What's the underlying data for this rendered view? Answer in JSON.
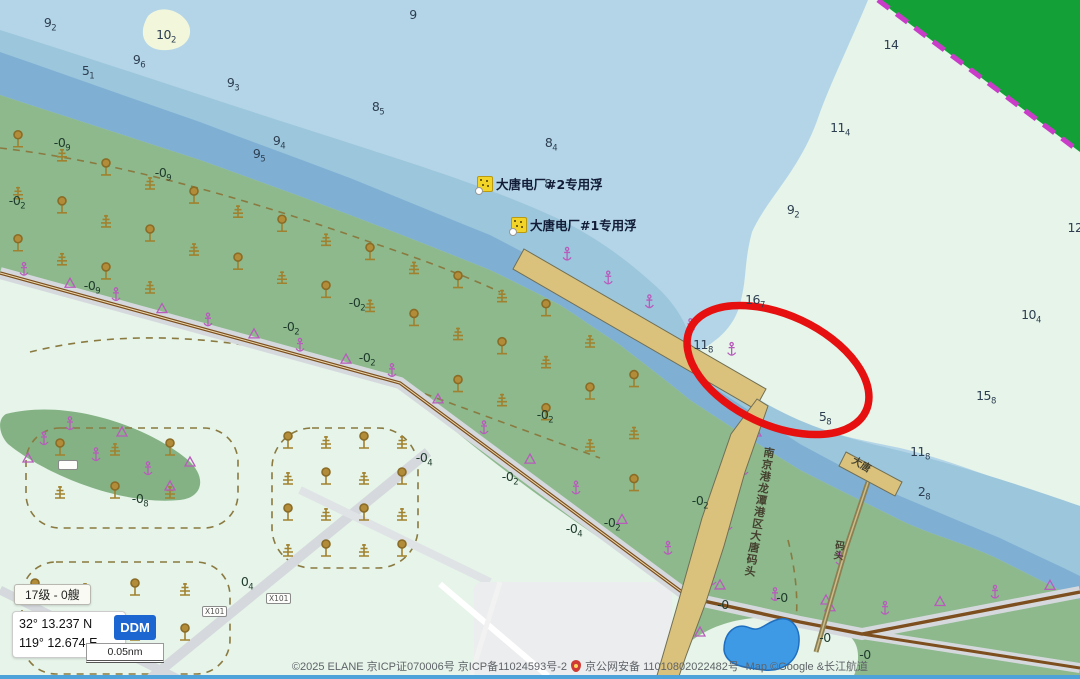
{
  "map": {
    "buoys": [
      {
        "label": "大唐电厂#2专用浮"
      },
      {
        "label": "大唐电厂#1专用浮"
      }
    ],
    "pier_labels": {
      "main": "南京港龙潭港区大唐码头",
      "small_top": "大唐",
      "small_bottom": "码头"
    },
    "road_signs": [
      {
        "text": "X101"
      },
      {
        "text": "X101"
      },
      {
        "text": ""
      }
    ],
    "annotation": {
      "shape": "ellipse",
      "color": "#e61010"
    },
    "soundings": [
      {
        "x": 50,
        "y": 23,
        "v": "9",
        "s": "2",
        "k": "w"
      },
      {
        "x": 166,
        "y": 35,
        "v": "10",
        "s": "2",
        "k": "w"
      },
      {
        "x": 413,
        "y": 15,
        "v": "9",
        "s": "",
        "k": "w"
      },
      {
        "x": 88,
        "y": 71,
        "v": "5",
        "s": "1",
        "k": "w"
      },
      {
        "x": 139,
        "y": 60,
        "v": "9",
        "s": "6",
        "k": "w"
      },
      {
        "x": 233,
        "y": 83,
        "v": "9",
        "s": "3",
        "k": "w"
      },
      {
        "x": 378,
        "y": 107,
        "v": "8",
        "s": "5",
        "k": "w"
      },
      {
        "x": 279,
        "y": 141,
        "v": "9",
        "s": "4",
        "k": "w"
      },
      {
        "x": 259,
        "y": 154,
        "v": "9",
        "s": "5",
        "k": "w"
      },
      {
        "x": 551,
        "y": 143,
        "v": "8",
        "s": "4",
        "k": "w"
      },
      {
        "x": 548,
        "y": 184,
        "v": "8",
        "s": "",
        "k": "w"
      },
      {
        "x": 840,
        "y": 128,
        "v": "11",
        "s": "4",
        "k": "w"
      },
      {
        "x": 891,
        "y": 45,
        "v": "14",
        "s": "",
        "k": "w"
      },
      {
        "x": 793,
        "y": 210,
        "v": "9",
        "s": "2",
        "k": "w"
      },
      {
        "x": 755,
        "y": 300,
        "v": "16",
        "s": "7",
        "k": "w"
      },
      {
        "x": 1031,
        "y": 315,
        "v": "10",
        "s": "4",
        "k": "w"
      },
      {
        "x": 703,
        "y": 345,
        "v": "11",
        "s": "8",
        "k": "w"
      },
      {
        "x": 986,
        "y": 396,
        "v": "15",
        "s": "8",
        "k": "w"
      },
      {
        "x": 825,
        "y": 417,
        "v": "5",
        "s": "8",
        "k": "w"
      },
      {
        "x": 920,
        "y": 452,
        "v": "11",
        "s": "8",
        "k": "w"
      },
      {
        "x": 924,
        "y": 492,
        "v": "2",
        "s": "8",
        "k": "w"
      },
      {
        "x": 1075,
        "y": 228,
        "v": "12",
        "s": "",
        "k": "w"
      },
      {
        "x": 17,
        "y": 201,
        "v": "-0",
        "s": "2",
        "k": "l"
      },
      {
        "x": 62,
        "y": 143,
        "v": "-0",
        "s": "9",
        "k": "l"
      },
      {
        "x": 163,
        "y": 173,
        "v": "-0",
        "s": "9",
        "k": "l"
      },
      {
        "x": 92,
        "y": 286,
        "v": "-0",
        "s": "9",
        "k": "l"
      },
      {
        "x": 357,
        "y": 303,
        "v": "-0",
        "s": "2",
        "k": "l"
      },
      {
        "x": 291,
        "y": 327,
        "v": "-0",
        "s": "2",
        "k": "l"
      },
      {
        "x": 367,
        "y": 358,
        "v": "-0",
        "s": "2",
        "k": "l"
      },
      {
        "x": 545,
        "y": 415,
        "v": "-0",
        "s": "2",
        "k": "l"
      },
      {
        "x": 424,
        "y": 458,
        "v": "-0",
        "s": "4",
        "k": "l"
      },
      {
        "x": 510,
        "y": 477,
        "v": "-0",
        "s": "2",
        "k": "l"
      },
      {
        "x": 574,
        "y": 529,
        "v": "-0",
        "s": "4",
        "k": "l"
      },
      {
        "x": 612,
        "y": 523,
        "v": "-0",
        "s": "2",
        "k": "l"
      },
      {
        "x": 140,
        "y": 499,
        "v": "-0",
        "s": "8",
        "k": "l"
      },
      {
        "x": 700,
        "y": 501,
        "v": "-0",
        "s": "2",
        "k": "l"
      },
      {
        "x": 723,
        "y": 605,
        "v": "-0",
        "s": "",
        "k": "l"
      },
      {
        "x": 782,
        "y": 598,
        "v": "-0",
        "s": "",
        "k": "l"
      },
      {
        "x": 825,
        "y": 638,
        "v": "-0",
        "s": "",
        "k": "l"
      },
      {
        "x": 865,
        "y": 655,
        "v": "-0",
        "s": "",
        "k": "l"
      },
      {
        "x": 247,
        "y": 582,
        "v": "0",
        "s": "4",
        "k": "l"
      }
    ]
  },
  "ui": {
    "level_badge": "17级 - 0艘",
    "position": {
      "lat": "32° 13.237 N",
      "lon": "119° 12.674 E"
    },
    "format_button": "DDM",
    "scale_label": "0.05nm",
    "copyright_left": "©2025 ELANE  京ICP证070006号  京ICP备11024593号-2",
    "copyright_right": "京公网安备 11010802022482号  -Map ©Google &长江航道"
  },
  "colors": {
    "water_light": "#b3d5e7",
    "water_mid": "#9cc6dc",
    "water_dark": "#7fb0d4",
    "shallow_flat": "#e6f4e9",
    "land_green": "#8db98d",
    "forest_green": "#12a037",
    "jetty_tan": "#dac17c",
    "annotation_red": "#e61010",
    "symbol_magenta": "#b85cbc",
    "tree_brown": "#a0812f",
    "accent_blue": "#1b66d1"
  }
}
